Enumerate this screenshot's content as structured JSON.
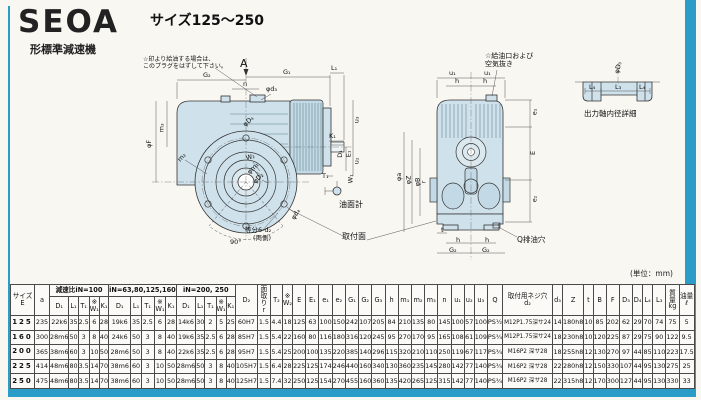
{
  "page": {
    "brand": "SEOA",
    "brand_sub": "形標準減速機",
    "title": "サイズ125～250",
    "unit_note": "(単位：mm)"
  },
  "colors": {
    "frame": "#2b9cc7",
    "body_fill": "#cfe2ec",
    "line": "#333333"
  },
  "drawing": {
    "labels": [
      {
        "t": "☆印より給油する場合は、\nこのプラグをはずして下さい。",
        "x": 143,
        "y": 56,
        "fs": 6,
        "n": "oil-fill-note"
      },
      {
        "t": "A",
        "x": 240,
        "y": 57,
        "fs": 11,
        "n": "section-mark-a"
      },
      {
        "t": "G₂",
        "x": 203,
        "y": 72,
        "n": "dim-g2-front"
      },
      {
        "t": "G₁",
        "x": 283,
        "y": 69,
        "n": "dim-g1"
      },
      {
        "t": "L₁",
        "x": 331,
        "y": 65,
        "n": "dim-l1"
      },
      {
        "t": "n",
        "x": 243,
        "y": 81,
        "n": "dim-n"
      },
      {
        "t": "φd₃",
        "x": 266,
        "y": 86,
        "n": "dim-d3"
      },
      {
        "t": "φD₄",
        "x": 243,
        "y": 118,
        "r": -42,
        "n": "dim-dd4"
      },
      {
        "t": "φF",
        "x": 146,
        "y": 140,
        "r": -90,
        "n": "dim-f"
      },
      {
        "t": "m₃",
        "x": 158,
        "y": 124,
        "r": -90,
        "n": "dim-m3"
      },
      {
        "t": "m₂",
        "x": 178,
        "y": 154,
        "r": -48,
        "n": "dim-m2"
      },
      {
        "t": "W₂",
        "x": 246,
        "y": 154,
        "r": -15,
        "n": "dim-w2"
      },
      {
        "t": "φm₁",
        "x": 247,
        "y": 165,
        "r": -45,
        "n": "dim-m1"
      },
      {
        "t": "φD₂",
        "x": 253,
        "y": 175,
        "r": -45,
        "n": "dim-dd2"
      },
      {
        "t": "K₁",
        "x": 329,
        "y": 133,
        "n": "dim-k1"
      },
      {
        "t": "D₁",
        "x": 337,
        "y": 150,
        "r": -90,
        "n": "dim-d1"
      },
      {
        "t": "E₁",
        "x": 346,
        "y": 150,
        "r": -90,
        "n": "dim-e1-front"
      },
      {
        "t": "u₃",
        "x": 354,
        "y": 116,
        "r": -90,
        "n": "dim-u3"
      },
      {
        "t": "u₂",
        "x": 354,
        "y": 157,
        "r": -90,
        "n": "dim-u2"
      },
      {
        "t": "T₁",
        "x": 322,
        "y": 173,
        "n": "dim-t1"
      },
      {
        "t": "W₁",
        "x": 347,
        "y": 175,
        "r": -90,
        "n": "dim-w1"
      },
      {
        "t": "φd₄",
        "x": 291,
        "y": 211,
        "r": -58,
        "n": "dim-d4"
      },
      {
        "t": "等分6-d₂",
        "x": 245,
        "y": 227,
        "n": "bolt-note"
      },
      {
        "t": "(両側)",
        "x": 253,
        "y": 235,
        "n": "bolt-note-2"
      },
      {
        "t": "90°",
        "x": 230,
        "y": 239,
        "n": "angle-90"
      },
      {
        "t": "油面計",
        "x": 339,
        "y": 200,
        "fs": 8,
        "n": "oil-gauge-label"
      },
      {
        "t": "取付面",
        "x": 342,
        "y": 232,
        "fs": 8,
        "n": "mounting-face-label"
      },
      {
        "t": "☆給油口および\n空気抜き",
        "x": 485,
        "y": 52,
        "fs": 7,
        "n": "air-vent-note"
      },
      {
        "t": "u₁",
        "x": 449,
        "y": 70,
        "n": "dim-u1a"
      },
      {
        "t": "u₁",
        "x": 484,
        "y": 70,
        "n": "dim-u1b"
      },
      {
        "t": "h",
        "x": 455,
        "y": 78,
        "n": "dim-h-top-a"
      },
      {
        "t": "h",
        "x": 483,
        "y": 78,
        "n": "dim-h-top-b"
      },
      {
        "t": "e₁",
        "x": 532,
        "y": 108,
        "r": -90,
        "n": "dim-e1-side"
      },
      {
        "t": "E",
        "x": 532,
        "y": 149,
        "r": -90,
        "n": "dim-e"
      },
      {
        "t": "e₂",
        "x": 532,
        "y": 195,
        "r": -90,
        "n": "dim-e2"
      },
      {
        "t": "φa",
        "x": 396,
        "y": 173,
        "r": -90,
        "n": "dim-a"
      },
      {
        "t": "φZ",
        "x": 405,
        "y": 176,
        "r": -90,
        "n": "dim-z"
      },
      {
        "t": "φB",
        "x": 414,
        "y": 178,
        "r": -90,
        "n": "dim-b"
      },
      {
        "t": "r",
        "x": 423,
        "y": 178,
        "r": -90,
        "n": "dim-r"
      },
      {
        "t": "t",
        "x": 441,
        "y": 227,
        "n": "dim-t"
      },
      {
        "t": "h",
        "x": 456,
        "y": 237,
        "n": "dim-h-bot-a"
      },
      {
        "t": "h",
        "x": 485,
        "y": 237,
        "n": "dim-h-bot-b"
      },
      {
        "t": "G₂",
        "x": 449,
        "y": 247,
        "n": "dim-g2a"
      },
      {
        "t": "G₂",
        "x": 482,
        "y": 247,
        "n": "dim-g2b"
      },
      {
        "t": "Q排油穴",
        "x": 517,
        "y": 235,
        "fs": 7.5,
        "n": "drain-label"
      },
      {
        "t": "φD₃",
        "x": 613,
        "y": 64,
        "r": -75,
        "n": "dim-dd3"
      },
      {
        "t": "L₄",
        "x": 589,
        "y": 84,
        "n": "dim-l4a"
      },
      {
        "t": "L₃",
        "x": 615,
        "y": 84,
        "n": "dim-l3"
      },
      {
        "t": "L₄",
        "x": 639,
        "y": 84,
        "n": "dim-l4b"
      },
      {
        "t": "出力軸内径詳細",
        "x": 584,
        "y": 109,
        "fs": 7.5,
        "n": "bore-detail-caption"
      }
    ]
  },
  "table": {
    "header_row1": [
      {
        "t": "サイズ\nE",
        "rs": 2
      },
      {
        "t": "a",
        "rs": 2
      },
      {
        "t": "減速比iN=100",
        "cs": 5
      },
      {
        "t": "iN=63,80,125,160",
        "cs": 5
      },
      {
        "t": "iN=200, 250",
        "cs": 5
      },
      {
        "t": "D₂",
        "rs": 2
      },
      {
        "t": "面取り\nr",
        "rs": 2
      },
      {
        "t": "T₂",
        "rs": 2
      },
      {
        "t": "※\nW₂",
        "rs": 2
      },
      {
        "t": "E",
        "rs": 2
      },
      {
        "t": "E₁",
        "rs": 2
      },
      {
        "t": "e₁",
        "rs": 2
      },
      {
        "t": "e₂",
        "rs": 2
      },
      {
        "t": "G₁",
        "rs": 2
      },
      {
        "t": "G₂",
        "rs": 2
      },
      {
        "t": "G₃",
        "rs": 2
      },
      {
        "t": "h",
        "rs": 2
      },
      {
        "t": "m₁",
        "rs": 2
      },
      {
        "t": "m₂",
        "rs": 2
      },
      {
        "t": "m₃",
        "rs": 2
      },
      {
        "t": "n",
        "rs": 2
      },
      {
        "t": "u₁",
        "rs": 2
      },
      {
        "t": "u₂",
        "rs": 2
      },
      {
        "t": "u₃",
        "rs": 2
      },
      {
        "t": "Q",
        "rs": 2
      },
      {
        "t": "取付用ネジ穴\nd₂",
        "rs": 2
      },
      {
        "t": "d₃",
        "rs": 2
      },
      {
        "t": "Z",
        "rs": 2
      },
      {
        "t": "t",
        "rs": 2
      },
      {
        "t": "B",
        "rs": 2
      },
      {
        "t": "F",
        "rs": 2
      },
      {
        "t": "D₃",
        "rs": 2
      },
      {
        "t": "D₄",
        "rs": 2
      },
      {
        "t": "L₄",
        "rs": 2
      },
      {
        "t": "L₃",
        "rs": 2
      },
      {
        "t": "質量\nkg",
        "rs": 2
      },
      {
        "t": "油量\nℓ",
        "rs": 2
      }
    ],
    "header_row2": [
      "D₁",
      "L₁",
      "T₁",
      "※\nW₁",
      "K₁",
      "D₁",
      "L₁",
      "T₁",
      "※\nW₁",
      "K₁",
      "D₁",
      "L₁",
      "T₁",
      "※\nW₁",
      "K₁"
    ],
    "rows": [
      [
        "125",
        "235",
        "22k6",
        "35",
        "2.5",
        "6",
        "28",
        "19k6",
        "35",
        "2.5",
        "6",
        "28",
        "14k6",
        "30",
        "2",
        "5",
        "25",
        "60H7",
        "1.5",
        "4.4",
        "18",
        "125",
        "63",
        "100",
        "150",
        "242",
        "107",
        "205",
        "84",
        "210",
        "135",
        "80",
        "145",
        "100",
        "57",
        "100",
        "PS½",
        "M12P1.75深サ24",
        "14",
        "180h8",
        "10",
        "85",
        "202",
        "62",
        "29",
        "70",
        "74",
        "75",
        "5"
      ],
      [
        "160",
        "300",
        "28m6",
        "50",
        "3",
        "8",
        "40",
        "24k6",
        "50",
        "3",
        "8",
        "40",
        "19k6",
        "35",
        "2.5",
        "6",
        "28",
        "85H7",
        "1.5",
        "5.4",
        "22",
        "160",
        "80",
        "116",
        "180",
        "316",
        "120",
        "245",
        "95",
        "270",
        "170",
        "95",
        "165",
        "108",
        "61",
        "109",
        "PS¾",
        "M12P1.75深サ24",
        "18",
        "230h8",
        "10",
        "120",
        "225",
        "87",
        "29",
        "75",
        "90",
        "122",
        "9.5"
      ],
      [
        "200",
        "365",
        "38m6",
        "60",
        "3",
        "10",
        "50",
        "28m6",
        "50",
        "3",
        "8",
        "40",
        "22k6",
        "35",
        "2.5",
        "6",
        "28",
        "95H7",
        "1.5",
        "5.4",
        "25",
        "200",
        "100",
        "135",
        "220",
        "385",
        "140",
        "296",
        "115",
        "320",
        "210",
        "110",
        "250",
        "119",
        "67",
        "117",
        "PS¾",
        "M16P2 深サ28",
        "18",
        "255h8",
        "12",
        "130",
        "270",
        "97",
        "44",
        "85",
        "110",
        "223",
        "17.5"
      ],
      [
        "225",
        "414",
        "48m6",
        "80",
        "3.5",
        "14",
        "70",
        "38m6",
        "60",
        "3",
        "10",
        "50",
        "28m6",
        "50",
        "3",
        "8",
        "40",
        "105H7",
        "1.5",
        "6.4",
        "28",
        "225",
        "125",
        "174",
        "246",
        "440",
        "160",
        "340",
        "130",
        "360",
        "235",
        "145",
        "280",
        "142",
        "77",
        "140",
        "PS¾",
        "M16P2 深サ28",
        "22",
        "280h8",
        "12",
        "150",
        "330",
        "107",
        "44",
        "95",
        "130",
        "275",
        "25"
      ],
      [
        "250",
        "475",
        "48m6",
        "80",
        "3.5",
        "14",
        "70",
        "38m6",
        "60",
        "3",
        "10",
        "50",
        "28m6",
        "50",
        "3",
        "8",
        "40",
        "125H7",
        "1.5",
        "7.4",
        "32",
        "250",
        "125",
        "154",
        "270",
        "455",
        "160",
        "360",
        "135",
        "420",
        "265",
        "125",
        "315",
        "142",
        "77",
        "140",
        "PS¾",
        "M16P2 深サ28",
        "22",
        "315h8",
        "12",
        "170",
        "300",
        "127",
        "44",
        "95",
        "130",
        "330",
        "33"
      ]
    ]
  }
}
